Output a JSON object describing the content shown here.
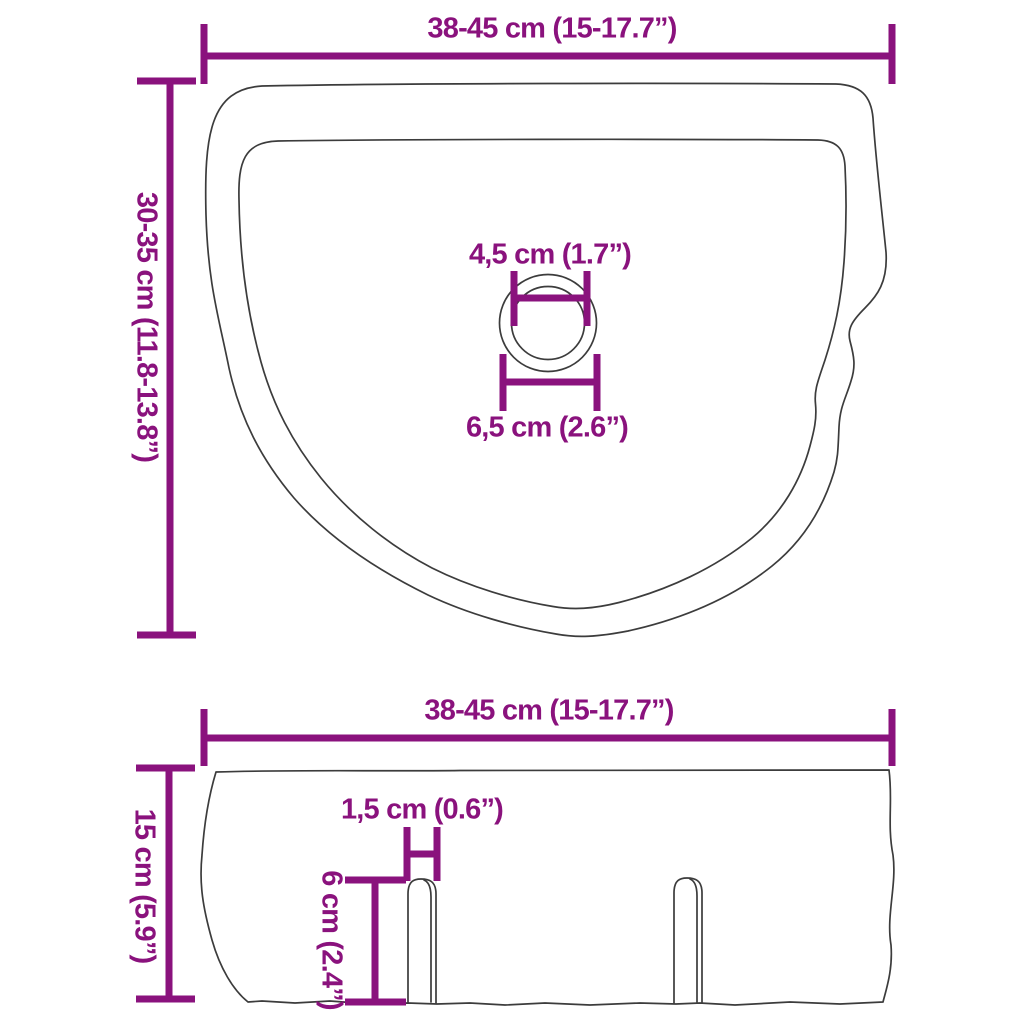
{
  "colors": {
    "dimension": "#8A127D",
    "outline": "#3c3c3c",
    "background": "#ffffff"
  },
  "top_view": {
    "width_label": "38-45 cm (15-17.7”)",
    "depth_label": "30-35 cm (11.8-13.8”)",
    "drain_inner_label": "4,5 cm (1.7”)",
    "drain_outer_label": "6,5 cm (2.6”)"
  },
  "side_view": {
    "width_label": "38-45 cm (15-17.7”)",
    "height_label": "15 cm (5.9”)",
    "slot_width_label": "1,5 cm (0.6”)",
    "slot_height_label": "6 cm (2.4”)"
  }
}
